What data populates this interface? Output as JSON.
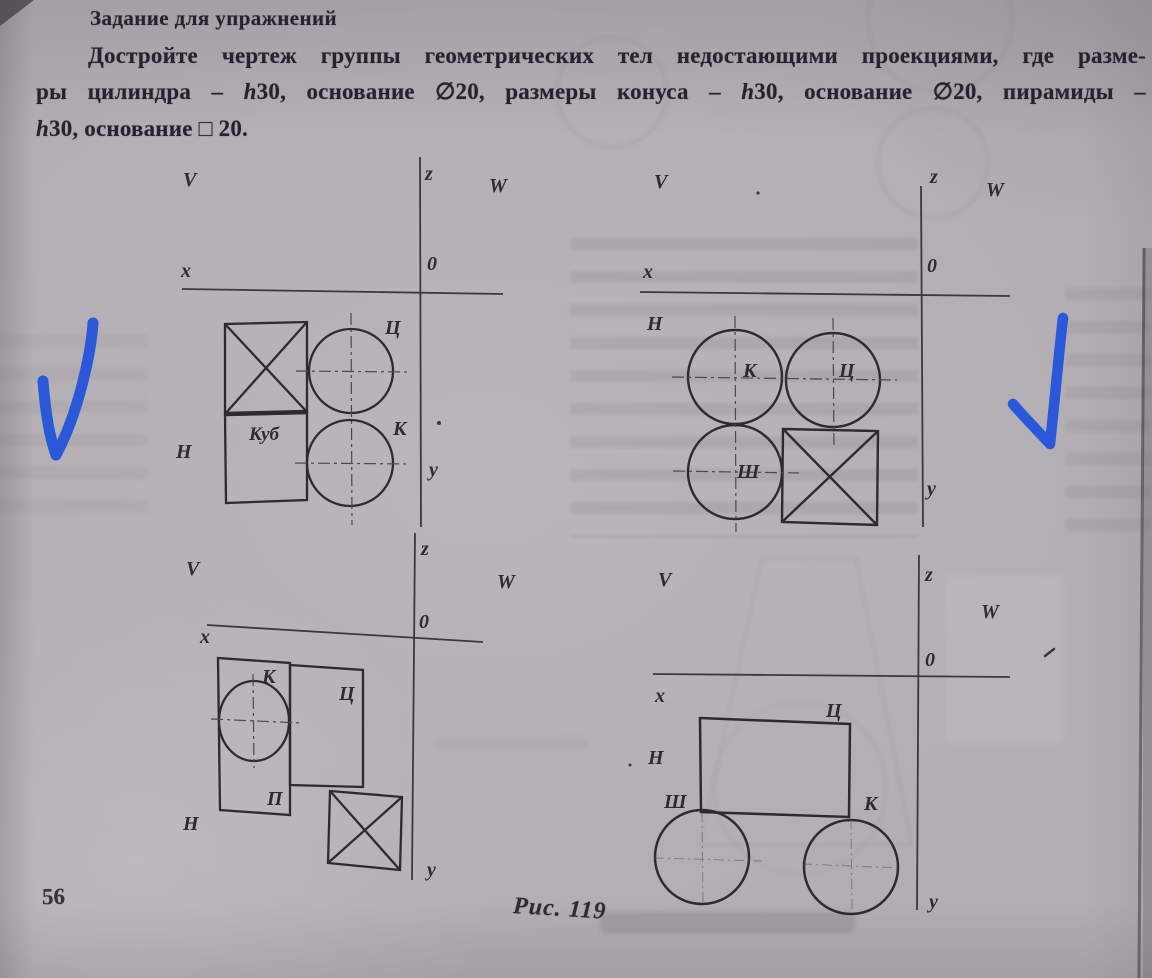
{
  "header": {
    "title": "Задание для упражнений",
    "paragraph_lines": [
      "Достройте чертеж группы геометрических тел недостающими проекциями, где разме-",
      "ры цилиндра – h30, основание ∅20, размеры конуса – h30, основание ∅20, пирамиды –",
      "h30, основание □ 20."
    ]
  },
  "footer": {
    "page_number": "56",
    "figure_caption": "Рис. 119"
  },
  "colors": {
    "paper": "#b2aeb3",
    "ink": "#2d2a31",
    "pen_blue": "#2b58d8"
  },
  "diagrams": {
    "top_left": {
      "axis": {
        "v": "V",
        "z": "z",
        "w": "W",
        "x": "x",
        "o": "0",
        "h": "H",
        "y": "у"
      },
      "shapes": {
        "cube": "Куб",
        "cylinder": "Ц",
        "cone": "К"
      }
    },
    "top_right": {
      "axis": {
        "v": "V",
        "z": "z",
        "w": "W",
        "x": "x",
        "o": "0",
        "h": "H",
        "y": "у"
      },
      "shapes": {
        "cone": "К",
        "cylinder": "Ц",
        "sphere": "Ш"
      }
    },
    "bottom_left": {
      "axis": {
        "v": "V",
        "z": "z",
        "w": "W",
        "x": "x",
        "o": "0",
        "h": "H",
        "y": "у"
      },
      "shapes": {
        "cone": "К",
        "pyramid": "П",
        "cylinder": "Ц"
      }
    },
    "bottom_right": {
      "axis": {
        "v": "V",
        "z": "z",
        "w": "W",
        "x": "x",
        "o": "0",
        "h": "H",
        "y": "у"
      },
      "shapes": {
        "cylinder": "Ц",
        "sphere": "Ш",
        "cone": "К"
      }
    }
  },
  "annotations": {
    "checkmark_count": "2",
    "checkmark_color": "#2b58d8"
  }
}
